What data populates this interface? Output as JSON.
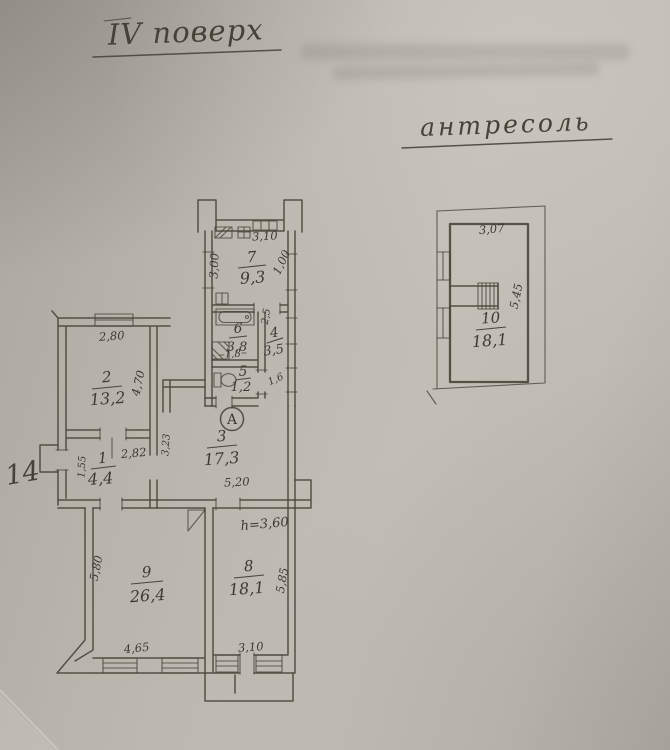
{
  "photo": {
    "floor_title": "IV поверх",
    "mezzanine_title": "антресоль",
    "margin_number": "14",
    "section_marker": "A"
  },
  "main_plan": {
    "rooms": {
      "r1": {
        "num": "1",
        "area": "4,4"
      },
      "r2": {
        "num": "2",
        "area": "13,2"
      },
      "r3": {
        "num": "3",
        "area": "17,3"
      },
      "r4": {
        "num": "4",
        "area": "3,5"
      },
      "r5": {
        "num": "5",
        "area": "1,2"
      },
      "r6": {
        "num": "6",
        "area": "3,8"
      },
      "r7": {
        "num": "7",
        "area": "9,3"
      },
      "r8": {
        "num": "8",
        "area": "18,1"
      },
      "r9": {
        "num": "9",
        "area": "26,4"
      }
    },
    "dimensions": {
      "room7_top": "3,10",
      "room7_left": "3,00",
      "room7_right": "1,00",
      "room6_width": "1,8",
      "room4_top": "2,5",
      "room4_bottom": "1,6",
      "room2_top": "2,80",
      "room2_right": "4,70",
      "room1_left": "1,55",
      "room1_top": "2,82",
      "room3_left": "3,23",
      "room3_bottom": "5,20",
      "room9_left": "5,80",
      "room9_bottom": "4,65",
      "room8_ceiling": "h=3,60",
      "room8_right": "5,85",
      "room8_bottom": "3,10"
    }
  },
  "mezzanine_plan": {
    "room": {
      "num": "10",
      "area": "18,1"
    },
    "dimensions": {
      "top": "3,07",
      "right": "5,45"
    }
  }
}
